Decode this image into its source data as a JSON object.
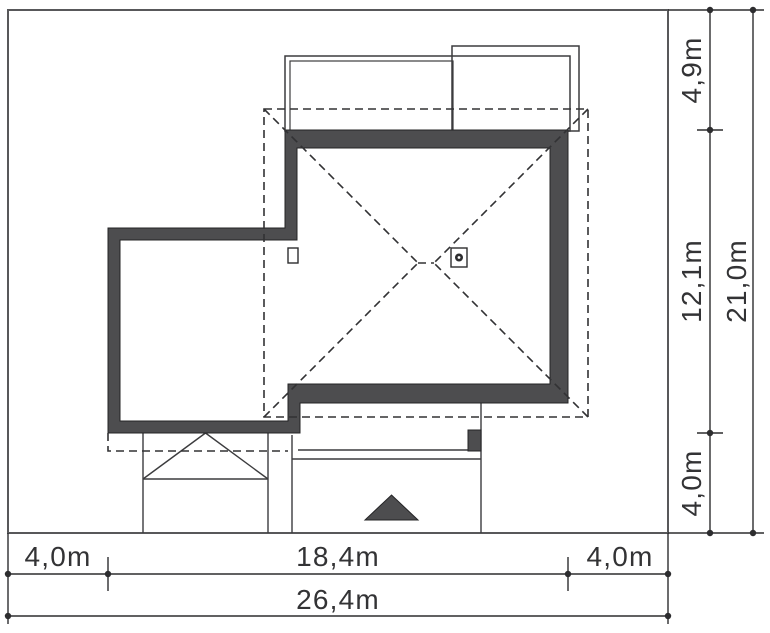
{
  "drawing": {
    "kind": "house-site-plan",
    "labels": {
      "right_back": "4,9m",
      "right_house": "12,1m",
      "right_front": "4,0m",
      "right_total": "21,0m",
      "bottom_left": "4,0m",
      "bottom_house": "18,4m",
      "bottom_right": "4,0m",
      "bottom_total": "26,4m"
    },
    "values_m": {
      "plot_width": 26.4,
      "plot_depth": 21.0,
      "house_width": 18.4,
      "house_depth": 12.1,
      "setback_left": 4.0,
      "setback_right": 4.0,
      "setback_front": 4.0,
      "setback_back": 4.9
    },
    "colors": {
      "background": "#ffffff",
      "wall_fill": "#4d4d4f",
      "wall_edge": "#242426",
      "thin_line": "#3c3c3e",
      "dashed_line": "#323234",
      "dimension": "#2d2d2f",
      "plot_border": "#58585a"
    }
  }
}
